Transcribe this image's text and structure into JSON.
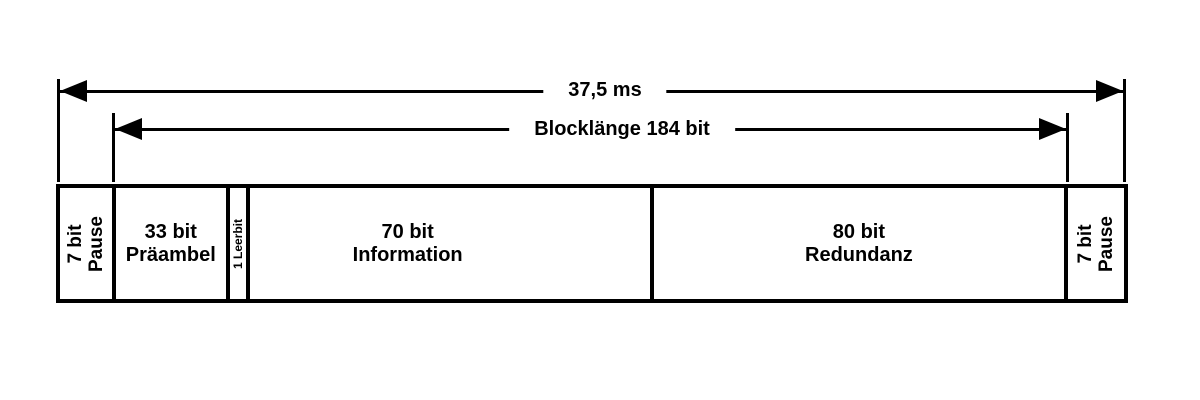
{
  "colors": {
    "ink": "#000000",
    "background": "#ffffff"
  },
  "timing_arrow": {
    "label": "37,5 ms"
  },
  "block_arrow": {
    "label": "Blocklänge 184 bit"
  },
  "frame": {
    "segments": [
      {
        "id": "pause-leading",
        "line1": "7 bit",
        "line2": "Pause",
        "orientation": "vertical"
      },
      {
        "id": "praeambel",
        "line1": "33 bit",
        "line2": "Präambel",
        "orientation": "horizontal"
      },
      {
        "id": "leerbit",
        "line1": "1 Leerbit",
        "orientation": "vertical"
      },
      {
        "id": "information",
        "line1": "70 bit",
        "line2": "Information",
        "orientation": "horizontal"
      },
      {
        "id": "redundanz",
        "line1": "80 bit",
        "line2": "Redundanz",
        "orientation": "horizontal"
      },
      {
        "id": "pause-trailing",
        "line1": "7 bit",
        "line2": "Pause",
        "orientation": "vertical"
      }
    ]
  }
}
